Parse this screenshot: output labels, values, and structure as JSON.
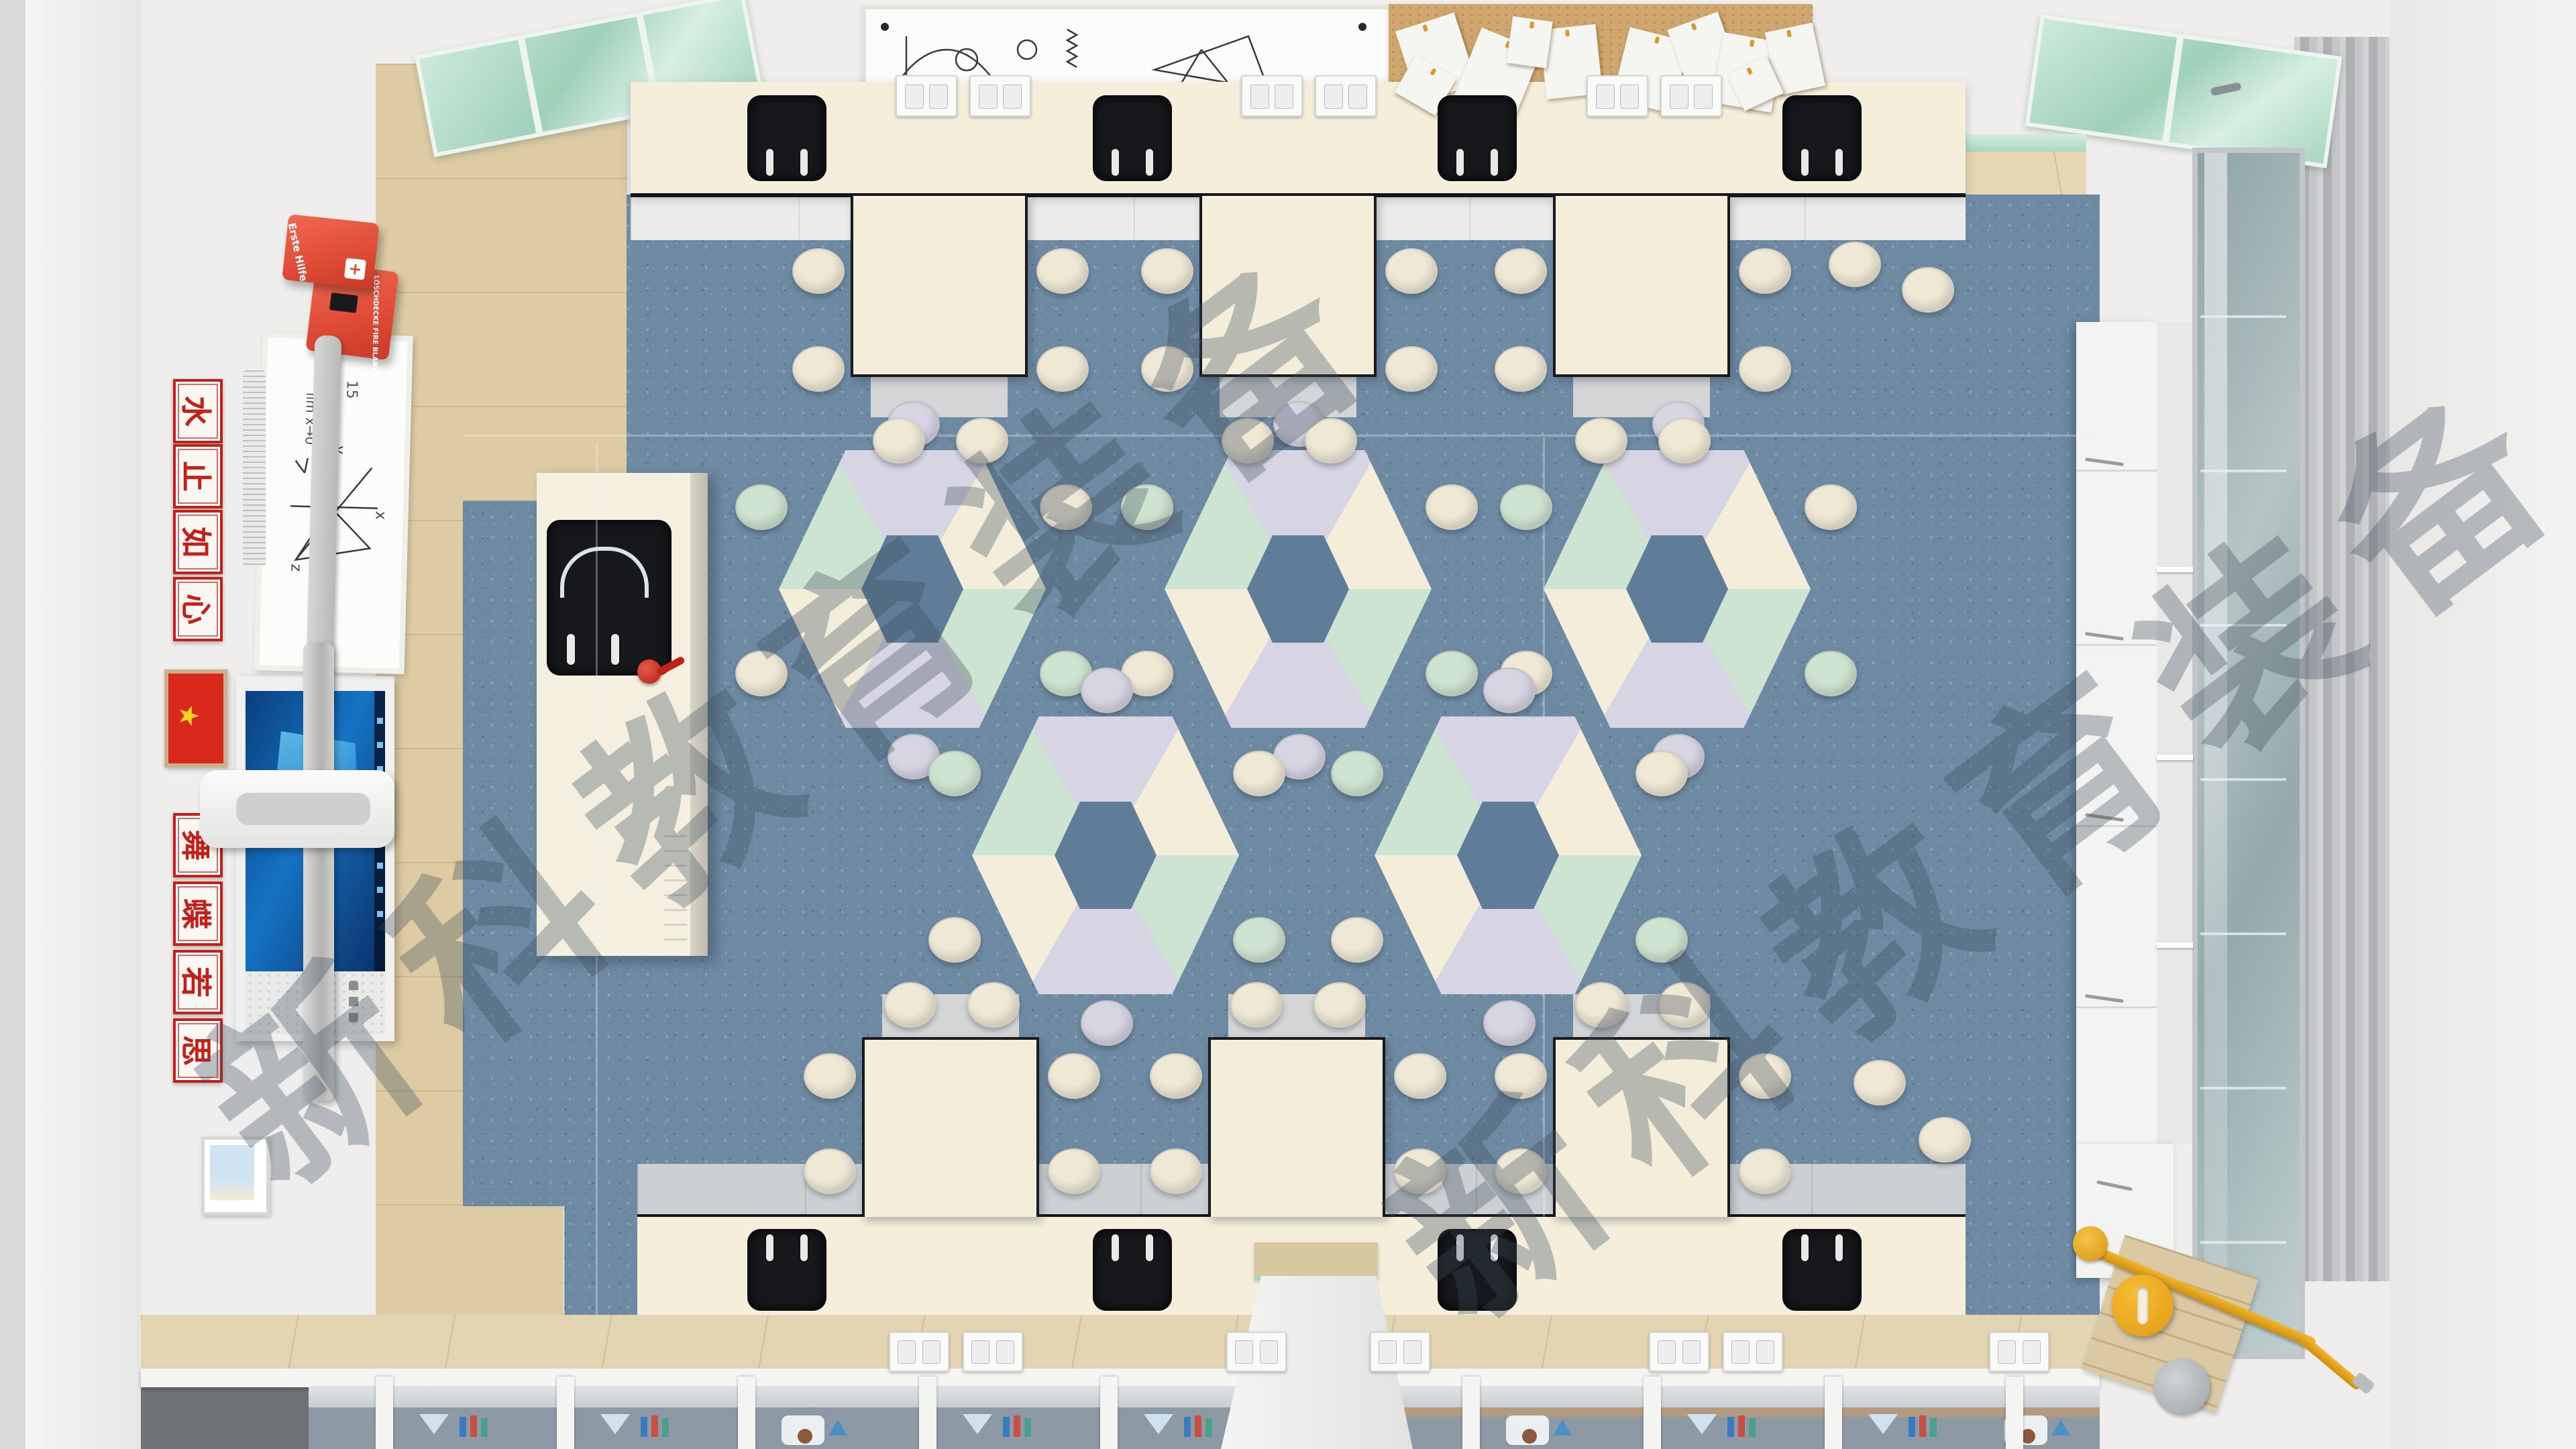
{
  "description": "Top-down 3D render of a school science classroom / laboratory",
  "watermark": {
    "text": "新科教育装备",
    "occurrences": 2,
    "color": "rgba(62,76,92,0.33)"
  },
  "left_wall": {
    "plaques_top": [
      "水",
      "止",
      "如",
      "心"
    ],
    "plaques_top_phrase": "心如止水",
    "plaques_bottom": [
      "舞",
      "蝶",
      "若",
      "思"
    ],
    "plaques_bottom_phrase": "思若蝶舞",
    "first_aid_box_label": "Erste Hilfe",
    "fire_blanket_box_label": "LÖSCHDECKE FIRE BLANKET",
    "whiteboard_annotations": {
      "limit": "lim x→0",
      "value": "15",
      "axis_x": "x",
      "axis_y": "y",
      "axis_z": "z"
    }
  },
  "top_wall": {
    "whiteboard_formula": "u = Um·sin ωt",
    "cork_papers_count": 10
  },
  "palette": {
    "floor_blue": "#6e8aa3",
    "counter_cream": "#f4eedb",
    "table_cream": "#f3edda",
    "table_mint": "#cde4d2",
    "table_lavender": "#d7d4e3",
    "stool_cream": "#efe8d5",
    "stool_mint": "#cfe4d0",
    "stool_lavender": "#d8d5e3",
    "sink_black": "#17181b",
    "wood": "#ddcba4",
    "glass_mint": "#9fd0b8",
    "safety_red": "#df4a36",
    "flag_red": "#d9291c",
    "flag_yellow": "#f7d51d",
    "pipe_yellow": "#e8a71c",
    "poster_gray_blue": "#8d99a4",
    "screen_blue": "#1573c4"
  },
  "furniture": {
    "hex_tables_count": 5,
    "hex_segment_colors": [
      "lavender",
      "cream",
      "mint"
    ],
    "top_workbenches_count": 3,
    "bottom_workbenches_count": 3,
    "sinks_top_count": 4,
    "sinks_bottom_count": 4,
    "stool_colors": [
      "cream",
      "mint",
      "lavender"
    ]
  }
}
